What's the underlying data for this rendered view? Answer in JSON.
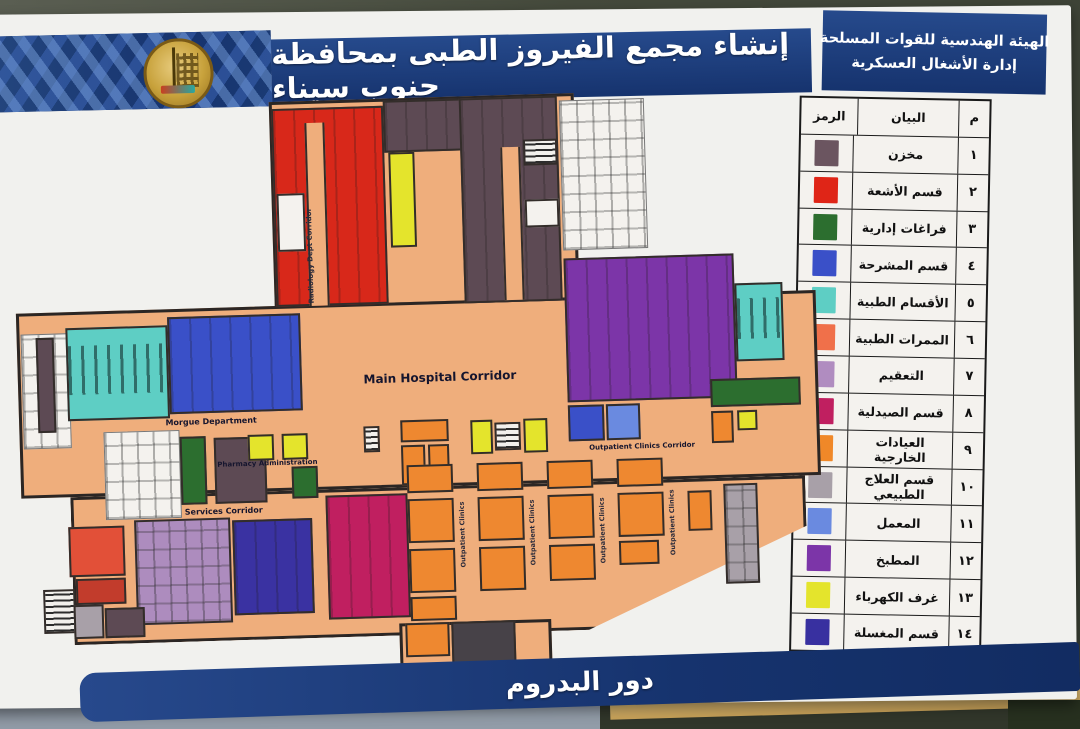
{
  "header": {
    "org_line1": "الهيئة الهندسية للقوات المسلحة",
    "org_line2": "إدارة الأشغال العسكرية",
    "title": "إنشاء مجمع الفيروز الطبى بمحافظة جنوب سيناء"
  },
  "footer": {
    "floor_label": "دور البدروم"
  },
  "legend": {
    "headers": {
      "num": "م",
      "description": "البيان",
      "symbol": "الرمز"
    },
    "rows": [
      {
        "num": "١",
        "label": "مخزن",
        "color": "#6b5560"
      },
      {
        "num": "٢",
        "label": "قسم الأشعة",
        "color": "#df2517"
      },
      {
        "num": "٣",
        "label": "فراغات إدارية",
        "color": "#2c6e2f"
      },
      {
        "num": "٤",
        "label": "قسم المشرحة",
        "color": "#3a50c8"
      },
      {
        "num": "٥",
        "label": "الأقسام الطبية",
        "color": "#5ecec4"
      },
      {
        "num": "٦",
        "label": "الممرات الطبية",
        "color": "#f0704a"
      },
      {
        "num": "٧",
        "label": "التعقيم",
        "color": "#b08cc0"
      },
      {
        "num": "٨",
        "label": "قسم الصيدلية",
        "color": "#c01f60"
      },
      {
        "num": "٩",
        "label": "العيادات الخارجية",
        "color": "#f08828"
      },
      {
        "num": "١٠",
        "label": "قسم العلاج الطبيعي",
        "color": "#a8a0a8"
      },
      {
        "num": "١١",
        "label": "المعمل",
        "color": "#6a8ae0"
      },
      {
        "num": "١٢",
        "label": "المطبخ",
        "color": "#7c35a8"
      },
      {
        "num": "١٣",
        "label": "غرف الكهرباء",
        "color": "#e4e42c"
      },
      {
        "num": "١٤",
        "label": "قسم المغسلة",
        "color": "#3830a0"
      }
    ]
  },
  "plan": {
    "labels": {
      "main_corridor": "Main Hospital Corridor",
      "morgue_department": "Morgue Department",
      "pharmacy_administration": "Pharmacy Administration",
      "services_corridor": "Services Corridor",
      "outpatient_corridor": "Outpatient Clinics Corridor",
      "radiology_corridor": "Radiology Dept Corridor",
      "outpatient_vertical": "Outpatient Clinics"
    },
    "colors": {
      "corridor": "#efae7c",
      "storage": "#5d4a54",
      "radiology": "#d8281a",
      "admin_green": "#2c6e2f",
      "morgue_blue": "#3a50c8",
      "medical_teal": "#5ecec4",
      "med_corridor_salmon": "#e25038",
      "med_corridor_dark": "#c23c2c",
      "sterilization": "#ad8cbe",
      "pharmacy": "#c01f60",
      "outpatient": "#ee8830",
      "physio_gray": "#a8a0a8",
      "lab": "#6a8ae0",
      "kitchen": "#7c35a8",
      "electricity": "#e4e42c",
      "laundry": "#3a32a2",
      "dark_block": "#474248",
      "white_room": "#f4f2ee"
    }
  }
}
